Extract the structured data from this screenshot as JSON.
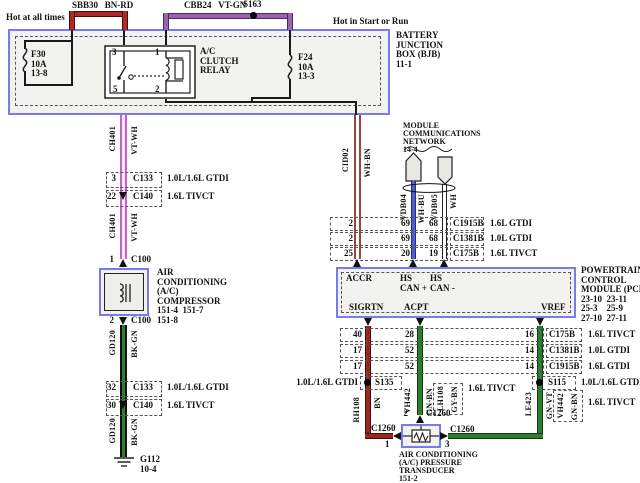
{
  "colors": {
    "box_border_blue": "#7a7af0",
    "box_fill": "#f2f2ee",
    "bn_rd": "#b02828",
    "vt_gn": "#9a63ad",
    "vt_wh": "#c75fce",
    "wh_bn": "#96463a",
    "wh_bu": "#4d5ed1",
    "wh": "#ffffff",
    "bk_gn": "#2e7d32",
    "bn": "#97291e",
    "gn_bn": "#2e7d32",
    "gn_vt": "#2e7d32",
    "black_wire": "#1a1a1a"
  },
  "top": {
    "hot_left": "Hot at all times",
    "hot_right": "Hot in Start or Run",
    "sbb30": "SBB30   BN-RD",
    "cbb24": "CBB24   VT-GN",
    "s163": "S163"
  },
  "bjb": {
    "label": "BATTERY\nJUNCTION\nBOX (BJB)\n11-1",
    "f30": "F30\n10A\n13-8",
    "f24": "F24\n10A\n13-3"
  },
  "relay": {
    "label": "A/C\nCLUTCH\nRELAY",
    "p3": "3",
    "p1": "1",
    "p5": "5",
    "p2": "2"
  },
  "wires": {
    "ch401": "CH401",
    "vt_wh": "VT-WH",
    "gd120": "GD120",
    "bk_gn": "BK-GN",
    "cid02": "CID02",
    "wh_bn": "WH-BN",
    "vdb04": "VDB04",
    "wh_bu": "WH-BU",
    "vdb05": "VDB05",
    "wh": "WH",
    "rh108": "RH108",
    "bn": "BN",
    "vh442": "VH442",
    "gn_bn": "GN-BN",
    "lh108": "LH108",
    "gy_bn": "GY-BN",
    "le423": "LE423",
    "gn_vt": "GN-VT"
  },
  "connectors": {
    "c133_top": {
      "pin": "3",
      "name": "C133",
      "note": "1.0L/1.6L GTDI"
    },
    "c140_top": {
      "pin": "22",
      "name": "C140",
      "note": "1.6L TIVCT"
    },
    "c100_top": {
      "pin": "1",
      "name": "C100"
    },
    "c100_bot": {
      "pin": "2",
      "name": "C100"
    },
    "c133_bot": {
      "pin": "32",
      "name": "C133",
      "note": "1.0L/1.6L GTDI"
    },
    "c140_bot": {
      "pin": "30",
      "name": "C140",
      "note": "1.6L TIVCT"
    }
  },
  "compressor": {
    "label": "AIR\nCONDITIONING\n(A/C)\nCOMPRESSOR\n151-4  151-7\n151-8"
  },
  "ground": {
    "label": "G112\n10-4"
  },
  "mcn": {
    "label": "MODULE\nCOMMUNICATIONS\nNETWORK\n14-4"
  },
  "rows_top": [
    {
      "p1": "2",
      "p2": "69",
      "p3": "68",
      "conn": "C1915B",
      "note": "1.6L GTDI"
    },
    {
      "p1": "2",
      "p2": "69",
      "p3": "68",
      "conn": "C1381B",
      "note": "1.0L GTDI"
    },
    {
      "p1": "25",
      "p2": "20",
      "p3": "19",
      "conn": "C175B",
      "note": "1.6L TIVCT"
    }
  ],
  "pcm": {
    "label": "POWERTRAIN\nCONTROL\nMODULE (PCM)\n23-10  23-11\n25-3    25-9\n27-10  27-11",
    "accr": "ACCR",
    "hs_can_p": "HS\nCAN +",
    "hs_can_n": "HS\nCAN -",
    "sigrtn": "SIGRTN",
    "acpt": "ACPT",
    "vref": "VREF"
  },
  "rows_bottom": [
    {
      "p1": "40",
      "p2": "28",
      "p3": "16",
      "conn": "C175B",
      "note": "1.6L TIVCT"
    },
    {
      "p1": "17",
      "p2": "52",
      "p3": "14",
      "conn": "C1381B",
      "note": "1.0L GTDI"
    },
    {
      "p1": "17",
      "p2": "52",
      "p3": "14",
      "conn": "C1915B",
      "note": "1.6L GTDI"
    }
  ],
  "splices": {
    "s135": "S135",
    "s135_note": "1.0L/1.6L GTDI",
    "s115": "S115",
    "s115_note": "1.0L/1.6L GTDI"
  },
  "alt_acpt": {
    "note": "1.6L TIVCT"
  },
  "alt_vref": {
    "note": "1.6L TIVCT"
  },
  "transducer": {
    "label": "AIR CONDITIONING\n(A/C) PRESSURE\nTRANSDUCER\n151-2",
    "p1": "1",
    "p2": "2",
    "p3": "3",
    "conn": "C1260"
  }
}
